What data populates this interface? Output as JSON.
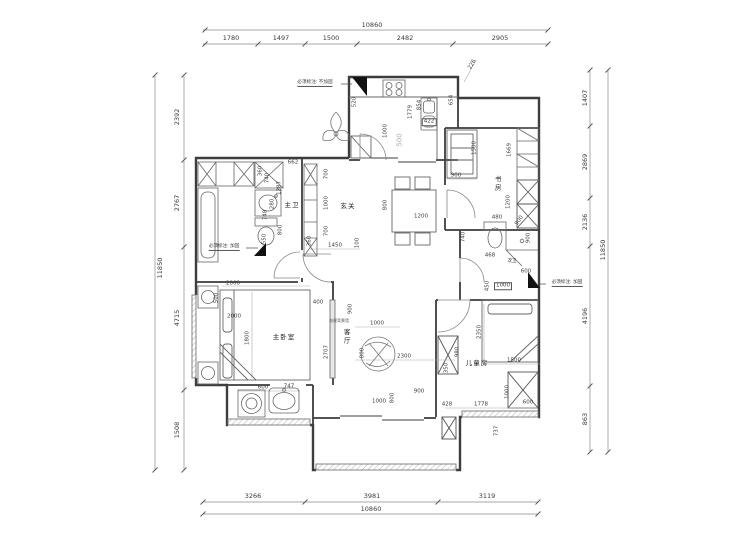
{
  "document": {
    "kind": "residential floor plan (CAD)",
    "unit": "mm"
  },
  "outer_dimensions": {
    "top": {
      "overall": "10860",
      "segments": [
        "1780",
        "1497",
        "1500",
        "2482",
        "2905"
      ]
    },
    "bottom": {
      "overall": "10860",
      "segments": [
        "3266",
        "3981",
        "3119"
      ]
    },
    "left": {
      "overall": "11850",
      "segments": [
        "2392",
        "2767",
        "4715",
        "1508"
      ]
    },
    "right": {
      "overall": "11850",
      "segments": [
        "1407",
        "2869",
        "2136",
        "4196",
        "863"
      ]
    }
  },
  "plan": {
    "rooms": [
      {
        "t": "主卫",
        "x": 292,
        "y": 205,
        "n": "room-label-master-bath"
      },
      {
        "t": "玄关",
        "x": 348,
        "y": 206,
        "n": "room-label-entry"
      },
      {
        "t": "书房",
        "x": 497,
        "y": 184,
        "v": true,
        "n": "room-label-study"
      },
      {
        "t": "次卫",
        "x": 512,
        "y": 262,
        "c": "sm",
        "n": "room-label-second-bath"
      },
      {
        "t": "儿童房",
        "x": 477,
        "y": 363,
        "n": "room-label-kids-room"
      },
      {
        "t": "主卧室",
        "x": 284,
        "y": 337,
        "n": "room-label-master-bedroom"
      },
      {
        "t": "客厅",
        "x": 346,
        "y": 337,
        "v": true,
        "n": "room-label-living-room"
      }
    ],
    "notes": [
      {
        "t": "必须标注: 不加固",
        "x": 315,
        "y": 84,
        "n": "note-no-reinforce"
      },
      {
        "t": "必须标注: 加固",
        "x": 224,
        "y": 248,
        "n": "note-reinforce-left"
      },
      {
        "t": "必须标注: 加固",
        "x": 567,
        "y": 284,
        "n": "note-reinforce-right"
      }
    ],
    "labels": [
      {
        "t": "10860",
        "x": 372,
        "y": 25,
        "c": "b"
      },
      {
        "t": "1780",
        "x": 231,
        "y": 38,
        "c": "b"
      },
      {
        "t": "1497",
        "x": 281,
        "y": 38,
        "c": "b"
      },
      {
        "t": "1500",
        "x": 331,
        "y": 38,
        "c": "b"
      },
      {
        "t": "2482",
        "x": 405,
        "y": 38,
        "c": "b"
      },
      {
        "t": "2905",
        "x": 500,
        "y": 38,
        "c": "b"
      },
      {
        "t": "3266",
        "x": 253,
        "y": 496,
        "c": "b"
      },
      {
        "t": "3981",
        "x": 372,
        "y": 496,
        "c": "b"
      },
      {
        "t": "3119",
        "x": 487,
        "y": 496,
        "c": "b"
      },
      {
        "t": "10860",
        "x": 371,
        "y": 509,
        "c": "b"
      },
      {
        "t": "11850",
        "x": 160,
        "y": 268,
        "r": -90,
        "c": "b"
      },
      {
        "t": "2392",
        "x": 177,
        "y": 117,
        "r": -90,
        "c": "b"
      },
      {
        "t": "2767",
        "x": 177,
        "y": 203,
        "r": -90,
        "c": "b"
      },
      {
        "t": "4715",
        "x": 177,
        "y": 318,
        "r": -90,
        "c": "b"
      },
      {
        "t": "1508",
        "x": 177,
        "y": 430,
        "r": -90,
        "c": "b"
      },
      {
        "t": "1407",
        "x": 585,
        "y": 98,
        "r": -90,
        "c": "b"
      },
      {
        "t": "2869",
        "x": 585,
        "y": 162,
        "r": -90,
        "c": "b"
      },
      {
        "t": "2136",
        "x": 585,
        "y": 222,
        "r": -90,
        "c": "b"
      },
      {
        "t": "4196",
        "x": 585,
        "y": 316,
        "r": -90,
        "c": "b"
      },
      {
        "t": "863",
        "x": 585,
        "y": 419,
        "r": -90,
        "c": "b"
      },
      {
        "t": "11850",
        "x": 603,
        "y": 250,
        "r": -90,
        "c": "b"
      },
      {
        "t": "662",
        "x": 293,
        "y": 163
      },
      {
        "t": "520",
        "x": 355,
        "y": 102,
        "r": -90
      },
      {
        "t": "1000",
        "x": 386,
        "y": 131,
        "r": -90
      },
      {
        "t": "500",
        "x": 400,
        "y": 140,
        "r": -90,
        "c": "gy"
      },
      {
        "t": "1779",
        "x": 411,
        "y": 112,
        "r": -90
      },
      {
        "t": "854",
        "x": 420,
        "y": 105,
        "r": -90
      },
      {
        "t": "422",
        "x": 429,
        "y": 122,
        "c": "bx"
      },
      {
        "t": "654",
        "x": 452,
        "y": 100,
        "r": -90
      },
      {
        "t": "226",
        "x": 473,
        "y": 65,
        "r": -60
      },
      {
        "t": "360",
        "x": 261,
        "y": 171,
        "r": -90
      },
      {
        "t": "740",
        "x": 268,
        "y": 178,
        "r": -90
      },
      {
        "t": "1287",
        "x": 280,
        "y": 188,
        "r": -90
      },
      {
        "t": "280",
        "x": 273,
        "y": 204,
        "r": -90
      },
      {
        "t": "748",
        "x": 266,
        "y": 215,
        "r": -90
      },
      {
        "t": "800",
        "x": 281,
        "y": 230,
        "r": -90
      },
      {
        "t": "550",
        "x": 265,
        "y": 239,
        "r": -90
      },
      {
        "t": "700",
        "x": 327,
        "y": 174,
        "r": -90
      },
      {
        "t": "1000",
        "x": 327,
        "y": 203,
        "r": -90
      },
      {
        "t": "700",
        "x": 327,
        "y": 231,
        "r": -90
      },
      {
        "t": "360",
        "x": 310,
        "y": 241,
        "r": -90
      },
      {
        "t": "1450",
        "x": 335,
        "y": 246
      },
      {
        "t": "100",
        "x": 358,
        "y": 243,
        "r": -90
      },
      {
        "t": "400",
        "x": 318,
        "y": 303
      },
      {
        "t": "900",
        "x": 351,
        "y": 309,
        "r": -90
      },
      {
        "t": "2707",
        "x": 327,
        "y": 352,
        "r": -90
      },
      {
        "t": "1000",
        "x": 377,
        "y": 324
      },
      {
        "t": "800",
        "x": 363,
        "y": 353,
        "r": -90
      },
      {
        "t": "2300",
        "x": 404,
        "y": 357
      },
      {
        "t": "电视背景墙",
        "x": 339,
        "y": 321,
        "c": "tiny"
      },
      {
        "t": "800",
        "x": 386,
        "y": 205,
        "r": -90
      },
      {
        "t": "1200",
        "x": 421,
        "y": 217
      },
      {
        "t": "1500",
        "x": 475,
        "y": 148,
        "r": -90
      },
      {
        "t": "900",
        "x": 456,
        "y": 176
      },
      {
        "t": "1669",
        "x": 510,
        "y": 150,
        "r": -90
      },
      {
        "t": "1200",
        "x": 509,
        "y": 202,
        "r": -90
      },
      {
        "t": "480",
        "x": 497,
        "y": 218
      },
      {
        "t": "900",
        "x": 520,
        "y": 221,
        "r": -55
      },
      {
        "t": "900",
        "x": 529,
        "y": 238,
        "r": -90
      },
      {
        "t": "740",
        "x": 464,
        "y": 237,
        "r": -90
      },
      {
        "t": "468",
        "x": 490,
        "y": 256
      },
      {
        "t": "600",
        "x": 526,
        "y": 272
      },
      {
        "t": "450",
        "x": 488,
        "y": 286,
        "r": -90
      },
      {
        "t": "1000",
        "x": 503,
        "y": 286,
        "c": "bx"
      },
      {
        "t": "2350",
        "x": 480,
        "y": 332,
        "r": -90
      },
      {
        "t": "1500",
        "x": 514,
        "y": 361
      },
      {
        "t": "980",
        "x": 458,
        "y": 352,
        "r": -90
      },
      {
        "t": "350",
        "x": 447,
        "y": 368,
        "r": -90
      },
      {
        "t": "1000",
        "x": 508,
        "y": 392,
        "r": -90
      },
      {
        "t": "600",
        "x": 528,
        "y": 403
      },
      {
        "t": "428",
        "x": 447,
        "y": 405
      },
      {
        "t": "1778",
        "x": 481,
        "y": 405
      },
      {
        "t": "737",
        "x": 497,
        "y": 431,
        "r": -90
      },
      {
        "t": "1000",
        "x": 379,
        "y": 402
      },
      {
        "t": "800",
        "x": 393,
        "y": 398,
        "r": -90
      },
      {
        "t": "900",
        "x": 419,
        "y": 392
      },
      {
        "t": "2000",
        "x": 233,
        "y": 284
      },
      {
        "t": "500",
        "x": 217,
        "y": 298,
        "r": -90
      },
      {
        "t": "2000",
        "x": 234,
        "y": 317
      },
      {
        "t": "1800",
        "x": 248,
        "y": 338,
        "r": -90
      },
      {
        "t": "600",
        "x": 263,
        "y": 388
      },
      {
        "t": "747",
        "x": 289,
        "y": 387
      }
    ]
  }
}
